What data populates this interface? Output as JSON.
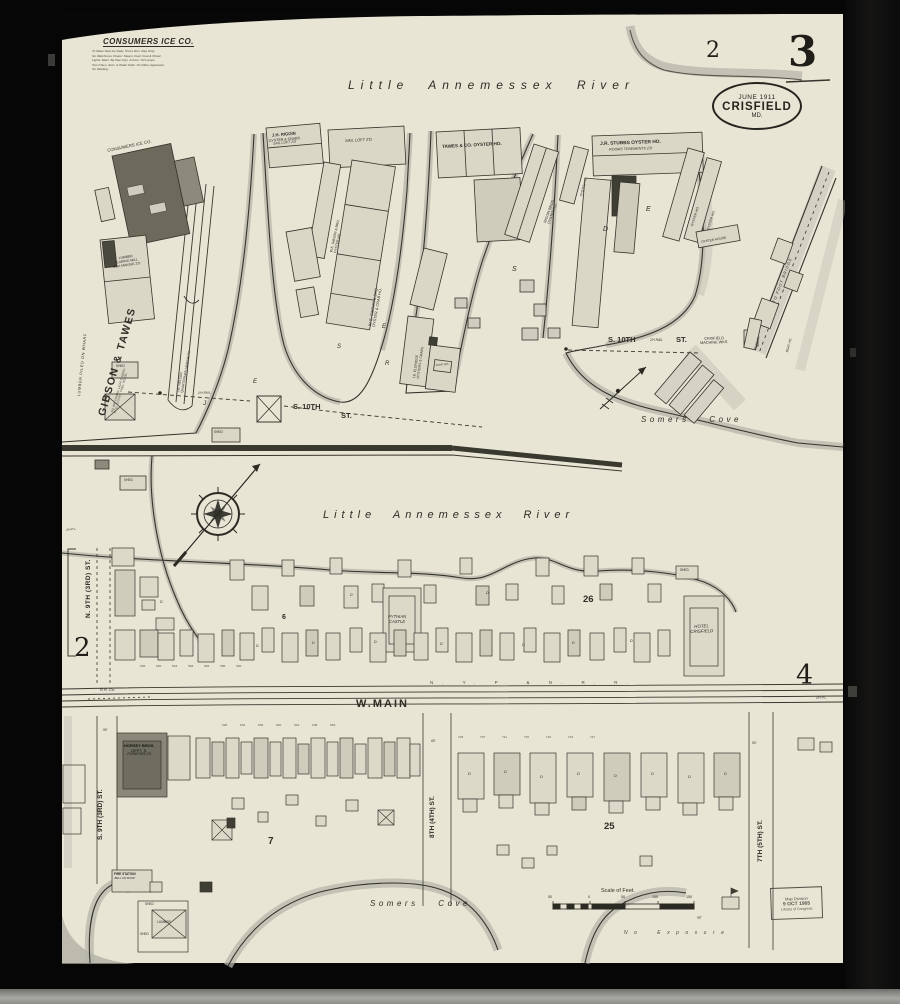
{
  "refs": {
    "sheet_no": "3",
    "top_sheet": "2",
    "left_sheet": "2",
    "right_sheet": "4"
  },
  "stamp": {
    "date": "JUNE 1911",
    "city": "CRISFIELD",
    "state": "MD."
  },
  "loc_stamp": {
    "l1": "Map Division",
    "l2": "9 OCT 1965",
    "l3": "Library of Congress"
  },
  "ice_note": {
    "title": "CONSUMERS ICE CO.",
    "l1": "To Make New Ice Daily. Hours Run: Day Only.",
    "l2": "No Watchman. Power: Steam. Fuel: Coal & Wood.",
    "l3": "Lights: Elect. By Own Dyn. & Kero. Oil Lamps.",
    "l4": "Two Chem. Exts. & Water Pails. No Other Apparatus.",
    "l5": "No Welding."
  },
  "water": {
    "river": "Little Annemessex River",
    "cove": "Somers Cove",
    "no_exposure": "No Exposure"
  },
  "streets": {
    "s10": "S. 10TH",
    "st": "ST.",
    "rail": "2'H RAIL",
    "wmain": "W.MAIN",
    "rr_letters": "N. Y. P. & N. R. R.",
    "rr_co": "R.R. Co.",
    "n9": "N. 9TH (3RD) ST.",
    "s9": "S. 9TH (3RD) ST.",
    "e8": "8TH (4TH) ST.",
    "e7": "7TH (5TH) ST.",
    "pole": "2'H P.L.",
    "foot_bridge": "TO FOOT BRIDGE"
  },
  "bld": {
    "consumers": "CONSUMERS ICE CO.",
    "saw1": "LUMBER",
    "saw2": "PLANING MILL",
    "saw3": "BOX MAKING 2'D",
    "gt": "GIBSON & TAWES",
    "gt_sub1": "NO WATCHMAN. LIGHTS: KERO.",
    "gt_sub2": "HT'D: STOVES. FUEL: WOOD.",
    "lumber_wharf": "LUMBER PILED ON WHARF",
    "nelson1": "J.B. NELSON",
    "nelson2": "QUARTERMAN MARINE RY.",
    "riggin1": "J.H. RIGGIN",
    "riggin2": "OYSTER & CRABS",
    "riggin3": "SAIL LOFT 2'D",
    "sail_loft": "SAIL LOFT 2'D",
    "gib1": "W.E. GIBSON & BRO.",
    "gib2": "OYSTER HO.",
    "gibc1": "W. E. GIBSON & BRO.",
    "gibc2": "OYSTER & CRAB HO.",
    "tawes": "TAWES & CO. OYSTER HO.",
    "rb1": "RIGGIN BROS.",
    "rb2": "OYSTER HO.",
    "oyster_ho": "OYSTER HO.",
    "oyster_house": "OYSTER HOUSE",
    "boat_ho": "BOAT HO.",
    "stubbs1": "J.R. STUBBS OYSTER HO.",
    "stubbs2": "ROOMS TENEMENTS 2'D",
    "eld1": "I.E. ELDRIDGE",
    "eld2": "OYSTERS & CRABS",
    "mach1": "CRISFIELD",
    "mach2": "MACHINE WKS.",
    "pyth1": "PYTHIAN",
    "pyth2": "CASTLE",
    "hotel1": "HOTEL",
    "hotel2": "CRISFIELD",
    "horsey1": "HORSEY BROS.",
    "horsey2": "DEPT. S.",
    "horsey3": "FURNITURE 2'D",
    "fire1": "FIRE STATION",
    "fire2": "BELL ON ROOF",
    "lumber": "LUMBER",
    "shed": "SHED"
  },
  "letters": {
    "j": "J",
    "e": "E",
    "r": "R",
    "s": "S",
    "d": "D"
  },
  "blocks": {
    "b6": "6",
    "b26": "26",
    "b7": "7",
    "b25": "25"
  },
  "scale": {
    "title": "Scale of Feet.",
    "ticks": [
      "50",
      "0",
      "50",
      "100",
      "150"
    ]
  },
  "dims": {
    "d50": "50'",
    "d65": "65'"
  },
  "numbers": {
    "mid": "536 540 544 548 552 556 560",
    "shops": "628 632 636 640 644 648 652",
    "east": "703 707 711 715 719 723 727"
  }
}
